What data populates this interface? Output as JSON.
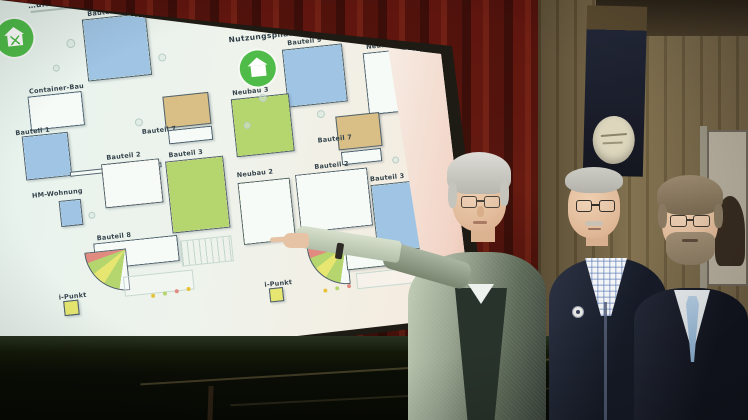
{
  "screen": {
    "left_plan": {
      "title": "…ult - Bestand",
      "icon": "house-tools-icon",
      "labels": [
        "Bauteil 9",
        "Container-Bau",
        "Bauteil 1",
        "Bauteil 7",
        "Bauteil 2",
        "Bauteil 3",
        "HM-Wohnung",
        "Bauteil 8",
        "i-Punkt"
      ]
    },
    "right_plan": {
      "title": "Nutzungsphase",
      "icon": "house-icon",
      "labels": [
        "Bauteil 9",
        "Neubau 1",
        "Neubau 3",
        "Bauteil 7",
        "Bauteil 2",
        "Neubau 2",
        "Bauteil 3",
        "i-Punkt"
      ]
    },
    "palette": {
      "b": "#9fc4e4",
      "y": "#e6e670",
      "r": "#e08a80",
      "g": "#b5d56e",
      "w": "#f6fbf8",
      "t": "#d9bf86"
    },
    "accent_green": "#4fbb49"
  },
  "colors": {
    "curtain_red": "#5f150e",
    "wall_brown": "#7d6c49",
    "stage_dark": "#0a0d05",
    "tie_blue": "#9dbede"
  },
  "figures": [
    {
      "name": "presenter-pointing-at-plan"
    },
    {
      "name": "man-plaid-shirt-dark-jacket"
    },
    {
      "name": "man-suit-blue-tie"
    }
  ]
}
